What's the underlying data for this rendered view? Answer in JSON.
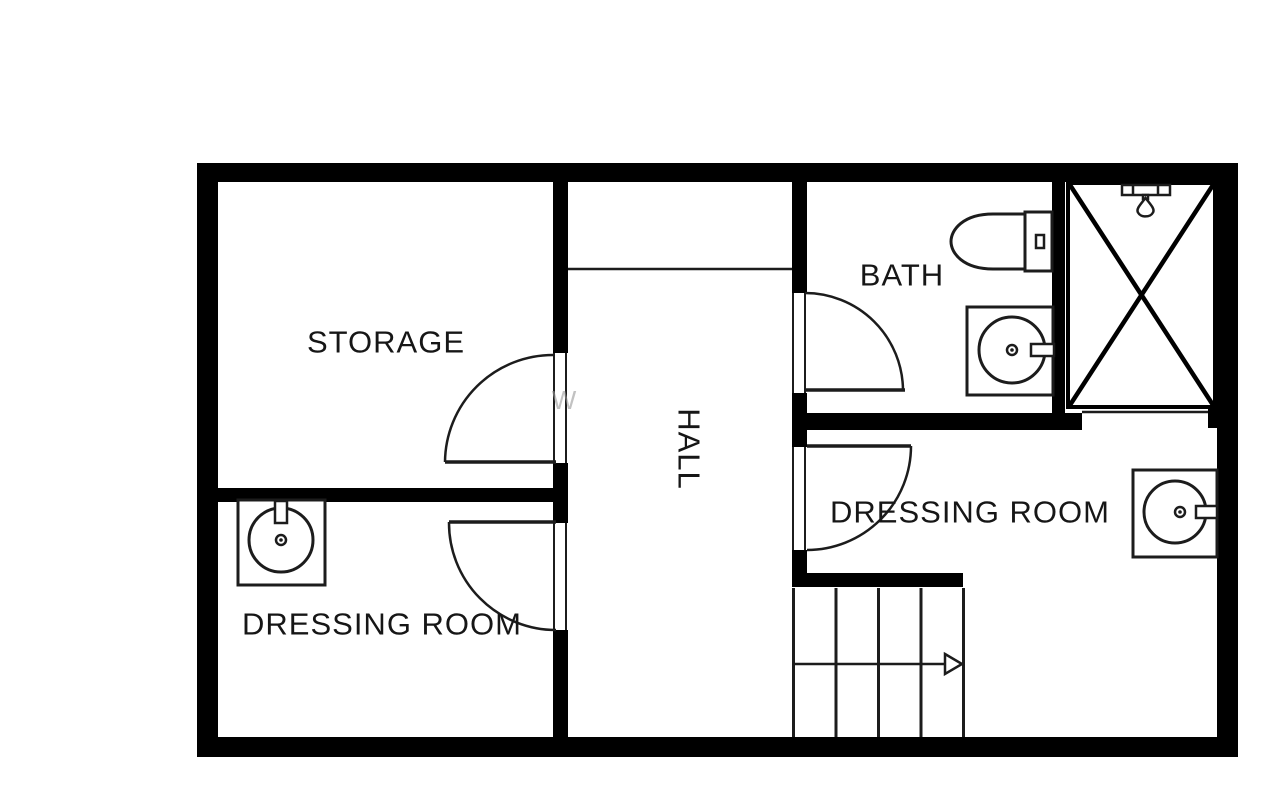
{
  "rooms": {
    "storage": {
      "label": "STORAGE"
    },
    "hall": {
      "label": "HALL"
    },
    "bath": {
      "label": "BATH"
    },
    "dressing_room_left": {
      "label": "DRESSING ROOM"
    },
    "dressing_room_right": {
      "label": "DRESSING ROOM"
    }
  },
  "fixtures": {
    "bath": [
      "toilet",
      "sink",
      "shower"
    ],
    "dressing_room_left": [
      "sink"
    ],
    "dressing_room_right": [
      "sink"
    ],
    "stairs": {
      "treads": 4,
      "direction_arrow": "right"
    }
  },
  "watermark": {
    "text": "W",
    "color": "#9b9b9b"
  },
  "colors": {
    "wall": "#000000",
    "line": "#1c1c1c",
    "background": "#ffffff",
    "label": "#161616"
  }
}
